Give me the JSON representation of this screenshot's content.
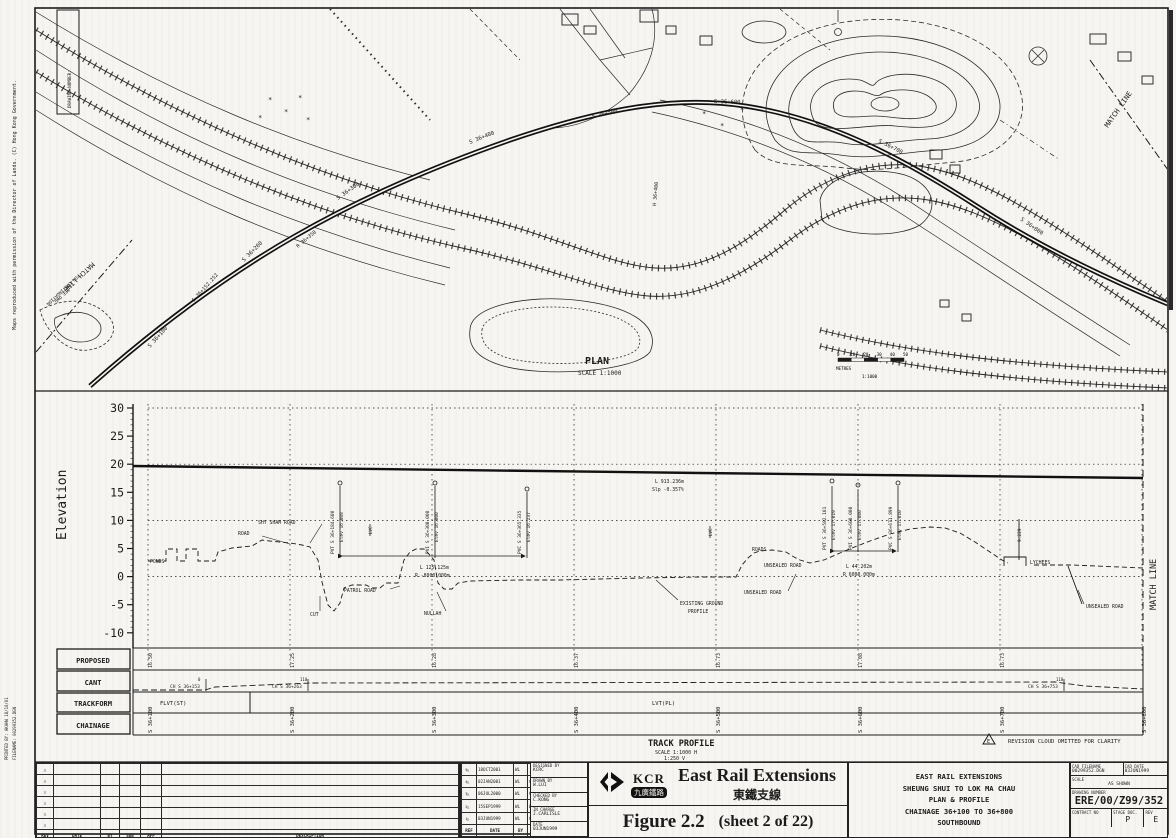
{
  "margin": {
    "copyright": "Maps reproduced with permission of the Director of Lands. (C) Hong Kong Government.",
    "printed_by": "PRINTED BY: AKAHW 18/10/01",
    "filename": "FILENAME: 00299352.DGN"
  },
  "plan": {
    "title": "PLAN",
    "scale": "SCALE 1:1000",
    "drawing_number_box": "DRAWING NUMBER:",
    "scale_bar": {
      "ticks": [
        "0",
        "10",
        "20",
        "30",
        "40",
        "50"
      ],
      "unit": "METRES",
      "ratio": "1:1000"
    },
    "labels": [
      {
        "t": "PLAN",
        "x": 585,
        "y": 364,
        "s": 10,
        "b": 1
      },
      {
        "t": "SCALE 1:1000",
        "x": 578,
        "y": 375,
        "s": 6
      },
      {
        "t": "MATCH LINE",
        "x": 1108,
        "y": 128,
        "s": 7,
        "rot": -55
      },
      {
        "t": "MATCH LINE",
        "x": 92,
        "y": 262,
        "s": 6.5,
        "rot": 137
      },
      {
        "t": "FOR CONTINUATION",
        "x": 78,
        "y": 274,
        "s": 4.5,
        "rot": 137
      },
      {
        "t": "SEE DWG",
        "x": 68,
        "y": 288,
        "s": 4.5,
        "rot": 137
      },
      {
        "t": "S 36+100",
        "x": 150,
        "y": 348,
        "s": 5.5,
        "rot": -48
      },
      {
        "t": "S 36+152.252",
        "x": 194,
        "y": 302,
        "s": 5,
        "rot": -48
      },
      {
        "t": "S 36+200",
        "x": 244,
        "y": 262,
        "s": 5.5,
        "rot": -45
      },
      {
        "t": "R 36+350",
        "x": 298,
        "y": 248,
        "s": 5,
        "rot": -40
      },
      {
        "t": "S 36+300",
        "x": 338,
        "y": 200,
        "s": 5.5,
        "rot": -35
      },
      {
        "t": "S 36+400",
        "x": 470,
        "y": 144,
        "s": 5.5,
        "rot": -22
      },
      {
        "t": "H 36+400",
        "x": 656,
        "y": 206,
        "s": 5,
        "rot": -85
      },
      {
        "t": "S 36+500",
        "x": 592,
        "y": 118,
        "s": 5.5,
        "rot": -12
      },
      {
        "t": "S 36+600",
        "x": 714,
        "y": 103,
        "s": 5.5,
        "rot": 2
      },
      {
        "t": "S 36+700",
        "x": 878,
        "y": 142,
        "s": 5.5,
        "rot": 27
      },
      {
        "t": "S 36+800",
        "x": 1020,
        "y": 220,
        "s": 5.5,
        "rot": 35
      }
    ]
  },
  "profile": {
    "ylabel": "Elevation",
    "yticks": [
      "30",
      "25",
      "20",
      "15",
      "10",
      "5",
      "0",
      "-5",
      "-10"
    ],
    "match_line": "MATCH LINE",
    "title": "TRACK PROFILE",
    "scale_h": "SCALE 1:1000 H",
    "scale_v": "1:250 V",
    "revision_note": "REVISION CLOUD OMITTED FOR CLARITY",
    "revision_note_ref": "E",
    "annotations": [
      {
        "t": "PONDS",
        "x": 150,
        "y": 563,
        "s": 4.8
      },
      {
        "t": "ROAD",
        "x": 238,
        "y": 535,
        "s": 4.8
      },
      {
        "t": "SHY SHAM ROAD",
        "x": 258,
        "y": 524,
        "s": 4.8
      },
      {
        "t": "CUT",
        "x": 310,
        "y": 616,
        "s": 4.8
      },
      {
        "t": "PATROL ROAD",
        "x": 344,
        "y": 592,
        "s": 4.8
      },
      {
        "t": "NULLAH",
        "x": 424,
        "y": 615,
        "s": 4.8
      },
      {
        "t": "L 125.125m",
        "x": 420,
        "y": 569,
        "s": 4.8
      },
      {
        "t": "R -8000.000m",
        "x": 415,
        "y": 577,
        "s": 4.8
      },
      {
        "t": "L 913.236m",
        "x": 655,
        "y": 483,
        "s": 4.8
      },
      {
        "t": "Slp -0.357%",
        "x": 652,
        "y": 491,
        "s": 4.8
      },
      {
        "t": "EXISTING GROUND",
        "x": 680,
        "y": 605,
        "s": 4.8
      },
      {
        "t": "PROFILE",
        "x": 688,
        "y": 613,
        "s": 4.8
      },
      {
        "t": "UNSEALED ROAD",
        "x": 744,
        "y": 594,
        "s": 4.8
      },
      {
        "t": "ROADS",
        "x": 752,
        "y": 551,
        "s": 4.8
      },
      {
        "t": "UNSEALED ROAD",
        "x": 764,
        "y": 567,
        "s": 4.8
      },
      {
        "t": "L 44.202m",
        "x": 846,
        "y": 568,
        "s": 4.8
      },
      {
        "t": "R 6000.000m",
        "x": 843,
        "y": 576,
        "s": 4.8
      },
      {
        "t": "LYCHEES",
        "x": 1030,
        "y": 564,
        "s": 4.8
      },
      {
        "t": "UNSEALED ROAD",
        "x": 1086,
        "y": 608,
        "s": 4.8
      },
      {
        "t": "9.229",
        "x": 1021,
        "y": 542,
        "s": 4.5,
        "rot": -90
      },
      {
        "t": "PVT S 36+184.600",
        "x": 334,
        "y": 554,
        "s": 4.5,
        "rot": -90
      },
      {
        "t": "Elev 16.808",
        "x": 343,
        "y": 542,
        "s": 4.5,
        "rot": -90
      },
      {
        "t": "LVC",
        "x": 372,
        "y": 534,
        "s": 4.2,
        "rot": -90
      },
      {
        "t": "PVI S 36+300.000",
        "x": 429,
        "y": 554,
        "s": 4.5,
        "rot": -90
      },
      {
        "t": "Elev 16.000",
        "x": 438,
        "y": 542,
        "s": 4.5,
        "rot": -90
      },
      {
        "t": "PVC S 36+365.335",
        "x": 521,
        "y": 554,
        "s": 4.5,
        "rot": -90
      },
      {
        "t": "Elev 16.237",
        "x": 530,
        "y": 542,
        "s": 4.5,
        "rot": -90
      },
      {
        "t": "LVC",
        "x": 712,
        "y": 536,
        "s": 4.2,
        "rot": -90
      },
      {
        "t": "PVT S 36+582.101",
        "x": 826,
        "y": 550,
        "s": 4.5,
        "rot": -90
      },
      {
        "t": "Elev 17.019",
        "x": 835,
        "y": 540,
        "s": 4.5,
        "rot": -90
      },
      {
        "t": "PVI S 36+600.000",
        "x": 852,
        "y": 550,
        "s": 4.5,
        "rot": -90
      },
      {
        "t": "Elev 17.000",
        "x": 861,
        "y": 540,
        "s": 4.5,
        "rot": -90
      },
      {
        "t": "PVC S 36+671.899",
        "x": 892,
        "y": 550,
        "s": 4.5,
        "rot": -90
      },
      {
        "t": "Elev 17.010",
        "x": 901,
        "y": 540,
        "s": 4.5,
        "rot": -90
      }
    ],
    "rows": {
      "proposed": {
        "label": "PROPOSED",
        "values": [
          "16.50",
          "17.25",
          "16.28",
          "16.37",
          "16.73",
          "17.08",
          "16.73"
        ]
      },
      "cant": {
        "label": "CANT",
        "marks": [
          {
            "x": 206,
            "ch": "CH S 36+153",
            "sup": "0"
          },
          {
            "x": 308,
            "ch": "CH S 36+263",
            "sup": "110"
          },
          {
            "x": 1064,
            "ch": "CH S 36+753",
            "sup": "110"
          }
        ]
      },
      "trackform": {
        "label": "TRACKFORM",
        "segments": [
          "FLVT(ST)",
          "LVT(PL)"
        ]
      },
      "chainage": {
        "label": "CHAINAGE",
        "values": [
          "S 36+100",
          "S 36+200",
          "S 36+300",
          "S 36+400",
          "S 36+500",
          "S 36+600",
          "S 36+700",
          "S 36+800"
        ]
      }
    }
  },
  "chart_data": {
    "type": "line",
    "title": "TRACK PROFILE",
    "ylabel": "Elevation",
    "ylim": [
      -10,
      30
    ],
    "grid": "dotted",
    "scales": [
      "1:1000 H",
      "1:250 V"
    ],
    "x_chainage": [
      "S 36+100",
      "S 36+200",
      "S 36+300",
      "S 36+400",
      "S 36+500",
      "S 36+600",
      "S 36+700",
      "S 36+800"
    ],
    "series": [
      {
        "name": "PROPOSED RAIL LEVEL",
        "values": [
          16.5,
          17.25,
          16.28,
          16.37,
          16.73,
          17.08,
          16.73,
          null
        ]
      },
      {
        "name": "EXISTING GROUND PROFILE (approx)",
        "values": [
          3.0,
          6.2,
          -0.9,
          -0.4,
          0.2,
          5.6,
          3.2,
          1.8
        ]
      }
    ],
    "vertical_curve_points": [
      "PVT S 36+184.600 Elev 16.808",
      "PVI S 36+300.000 Elev 16.000",
      "PVC S 36+365.335 Elev 16.237",
      "PVT S 36+582.101 Elev 17.019",
      "PVI S 36+600.000 Elev 17.000",
      "PVC S 36+671.899 Elev 17.010",
      "L 913.236m Slp -0.357%",
      "L 125.125m R -8000.000m",
      "L 44.202m R 6000.000m"
    ]
  },
  "title_block": {
    "empty_table": {
      "headers": [
        "REV",
        "DATE",
        "BY",
        "SUB",
        "APP",
        "DESCRIPTION"
      ],
      "empty_rows": 6
    },
    "rev_table": {
      "headers": [
        "REF",
        "DATE",
        "BY",
        "SUB",
        "APP",
        "DESCRIPTION"
      ],
      "rows": [
        {
          "ref": "5",
          "date": "18OCT2001",
          "by": "WL",
          "sub": "",
          "app": "",
          "desc": "UPDATED SCHEME BOUNDARY",
          "note": "12/4/01"
        },
        {
          "ref": "4",
          "date": "02JAN2001",
          "by": "WL",
          "sub": "CK",
          "app": "JRC",
          "desc": "WB PH2 REVISED",
          "note": ""
        },
        {
          "ref": "3",
          "date": "06JUL2000",
          "by": "WL",
          "sub": "CK",
          "app": "KW",
          "desc": "VERT PROFILE AND WB PH2 REVISED",
          "note": ""
        },
        {
          "ref": "2",
          "date": "15SEP1999",
          "by": "WL",
          "sub": "WS",
          "app": "CK",
          "desc": "VERTICAL PROFILE REVISED",
          "note": ""
        },
        {
          "ref": "1",
          "date": "03JUN1999",
          "by": "WL",
          "sub": "CK",
          "app": "JRC",
          "desc": "ISSUE FOR INFORMATION",
          "note": ""
        }
      ]
    },
    "signatories": [
      {
        "label": "DESIGNED BY",
        "value": "KCRC"
      },
      {
        "label": "DRAWN BY",
        "value": "W.LUI"
      },
      {
        "label": "CHECKED BY",
        "value": "C.KONG"
      },
      {
        "label": "IN CHARGE",
        "value": "J.CARLISLE"
      },
      {
        "label": "DATE",
        "value": "03JUN1999"
      }
    ],
    "logo": {
      "kcr": "KCR",
      "chinese": "九廣鐵路"
    },
    "project_en": "East Rail Extensions",
    "project_zh": "東鐵支線",
    "figure_label": "Figure 2.2",
    "figure_sheet": "(sheet 2 of 22)",
    "title_panel": [
      "EAST RAIL EXTENSIONS",
      "SHEUNG SHUI TO LOK MA CHAU",
      "PLAN & PROFILE",
      "CHAINAGE 36+100 TO 36+800",
      "SOUTHBOUND"
    ],
    "cad": {
      "filename_label": "CAD FILENAME",
      "filename": "00299352.DGN",
      "date_label": "CAD DATE",
      "date": "03JUN1999",
      "scale_label": "SCALE",
      "scale": "AS SHOWN",
      "number_label": "DRAWING NUMBER",
      "number": "ERE/00/Z99/352",
      "contract_label": "CONTRACT NO",
      "contract": "",
      "stage_label": "STAGE DOC.",
      "stage": "P",
      "rev_label": "REV",
      "rev": "E"
    }
  }
}
